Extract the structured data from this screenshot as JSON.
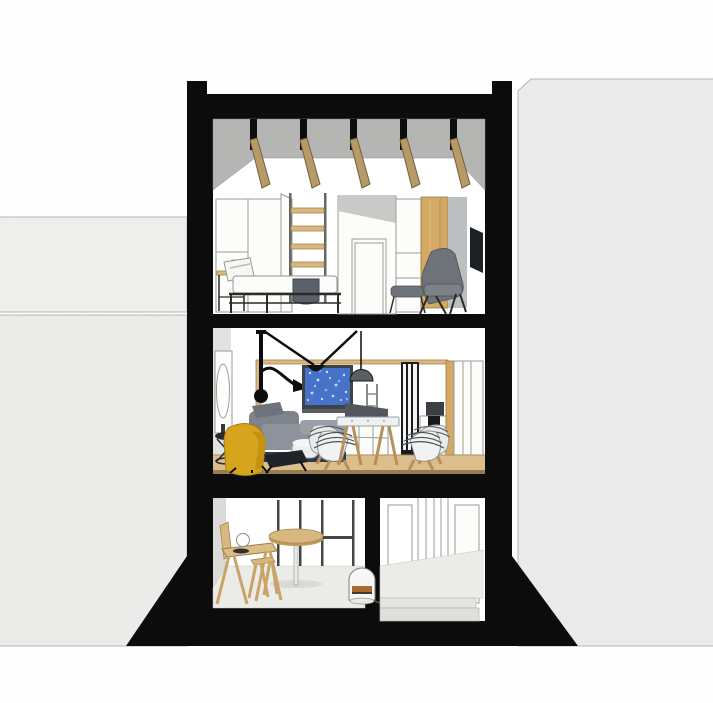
{
  "scene": {
    "type": "architectural-cross-section",
    "subject": "three-storey townhouse section with black cut outline between neighbouring buildings",
    "floors": [
      {
        "name": "loft-bedroom",
        "items": [
          "sloped-gray-ceiling",
          "five-wood-rafters",
          "wardrobe",
          "loft-ladder",
          "closet-door",
          "bed",
          "bedside-table",
          "sphere-lamp",
          "wood-wall-panel",
          "concrete-wall-panel",
          "wall-tv",
          "gray-lounge-chair",
          "ottoman"
        ]
      },
      {
        "name": "living-dining-room",
        "items": [
          "round-wall-mirror",
          "swing-arm-lamp",
          "suspension-cables",
          "blue-wall-art",
          "pendant-lamp",
          "open-shelf",
          "low-cabinet",
          "sofa",
          "white-pouf",
          "yellow-armchair",
          "black-footstool",
          "wire-side-table",
          "dining-table",
          "dining-chairs",
          "glazed-partition-door",
          "kitchen-cabinets",
          "wood-post-and-beam",
          "wood-floor"
        ]
      },
      {
        "name": "ground-floor-studio-and-entry",
        "items": [
          "glazed-partition-frame",
          "round-bar-table",
          "writing-desk",
          "desk-sphere-lamp",
          "stool",
          "white-floor-lamp",
          "entry-hall",
          "entry-steps",
          "concrete-floor"
        ]
      }
    ]
  },
  "colors": {
    "paper": "#ffffff",
    "black": "#0c0c0c",
    "neighbor_light": "#eff0ed",
    "neighbor_mid": "#ecedea",
    "neighbor_right": "#ebecea",
    "outline": "#b5b5b0",
    "ceiling_gray": "#b5b5b3",
    "wood_beam": "#b69a67",
    "wood_edge": "#73603f",
    "wood_panel": "#d3a965",
    "wood_light": "#d9b87f",
    "wood_floor": "#dcbe8c",
    "wood_floor_edge": "#8a7348",
    "concrete": "#bcbfbf",
    "chair_gray": "#6e7379",
    "navy": "#2c3850",
    "yellow": "#d7a41e",
    "yellow_shadow": "#a87d12",
    "tv_frame": "#3f4347",
    "screen_blue": "#4673c9",
    "pendant_gray": "#5a5f64",
    "floor_concrete": "#ebebe7",
    "amber": "#a96a2f"
  }
}
